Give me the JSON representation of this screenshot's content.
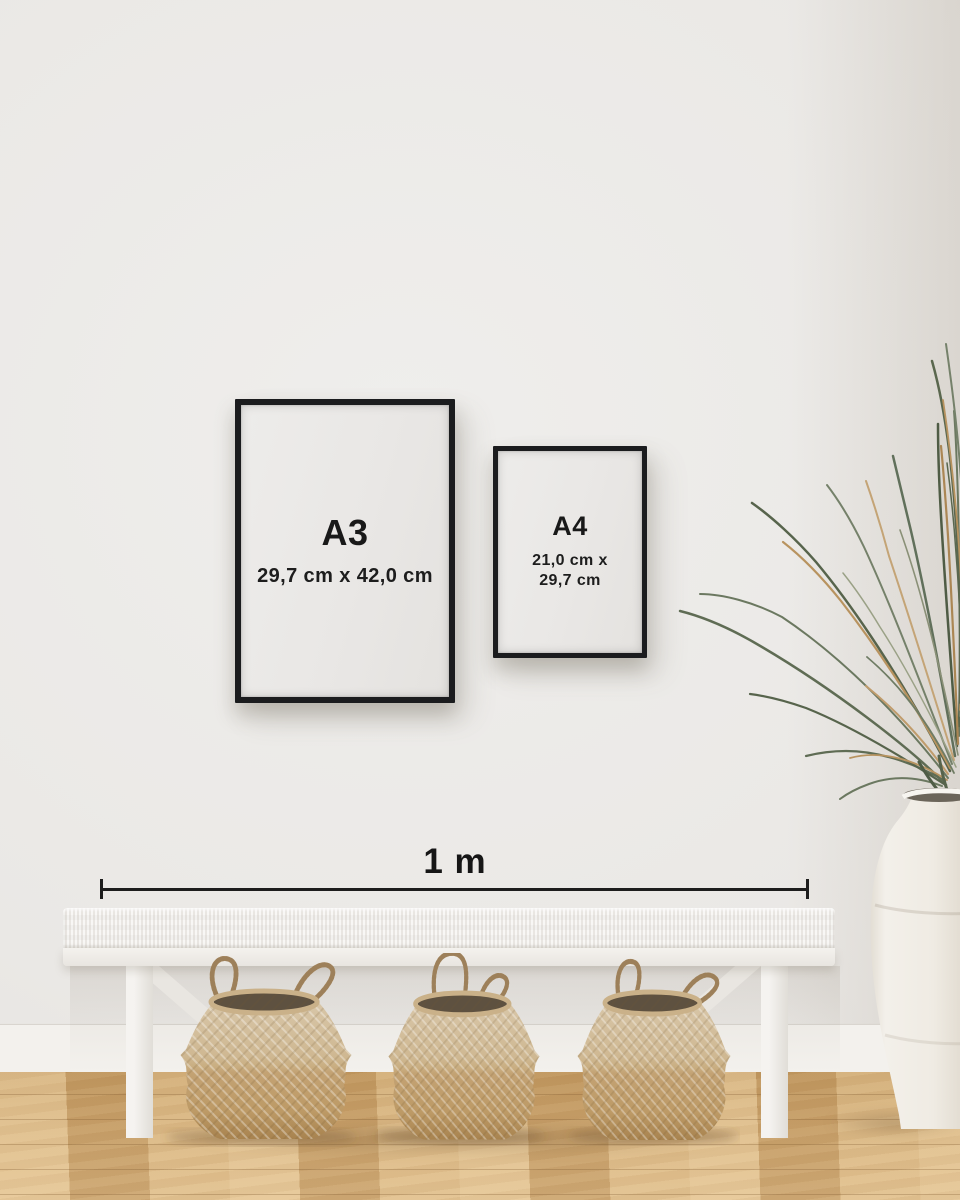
{
  "frames": {
    "a3": {
      "label": "A3",
      "dimensions": "29,7 cm x 42,0 cm"
    },
    "a4": {
      "label": "A4",
      "dimensions_line1": "21,0 cm x",
      "dimensions_line2": "29,7 cm"
    }
  },
  "scale_bar": {
    "label": "1 m"
  },
  "palette": {
    "wall": "#eae8e5",
    "baseboard": "#f3f1ed",
    "floor_light": "#ddba86",
    "floor_dark": "#c2975f",
    "frame_black": "#1b1c1e",
    "poster_paper": "#ebe9e7",
    "text": "#191919",
    "bench_white": "#f3f1ee",
    "basket_light": "#d6c3a4",
    "basket_dark": "#bd9a66",
    "plant_green": "#5f6c54",
    "plant_dried": "#b8935f",
    "vase_white": "#efece6"
  }
}
